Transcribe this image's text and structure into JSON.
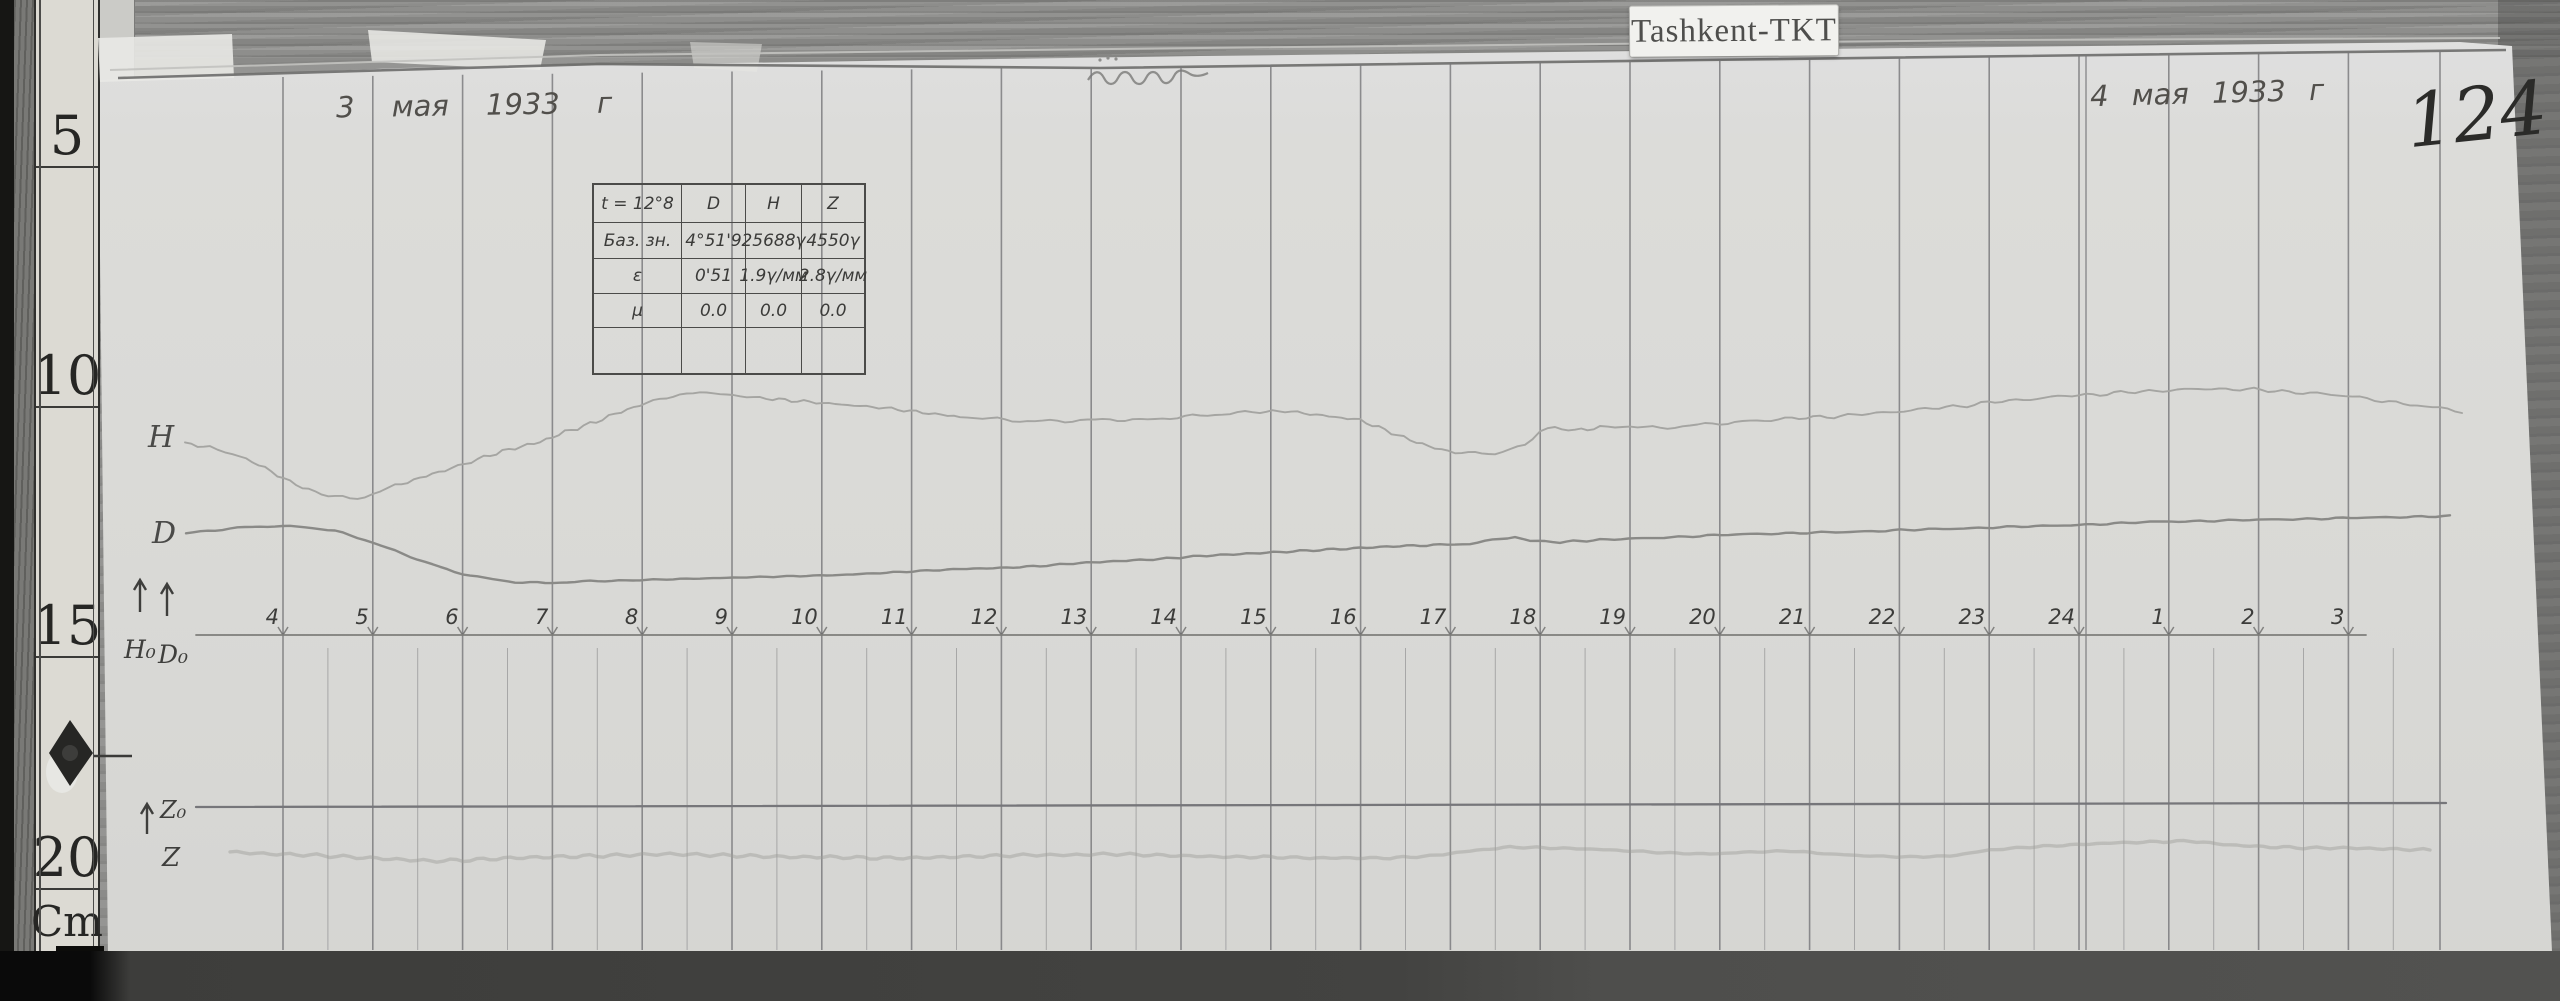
{
  "photo": {
    "station_label": "Tashkent-TKT",
    "page_number": "124",
    "date_left": "3 мая 1933 г",
    "date_right": "4 мая 1933 г",
    "top_center_note": "(illegible pencil scribble)"
  },
  "ruler": {
    "labels": [
      "5",
      "10",
      "15",
      "20",
      "Cm"
    ]
  },
  "trace_labels": {
    "h": "Н",
    "d": "D",
    "h0": "Н₀",
    "d0": "D₀",
    "z0": "Z₀",
    "z": "Z"
  },
  "table": {
    "headers": [
      "t = 12°8",
      "D",
      "H",
      "Z"
    ],
    "rows": [
      [
        "Баз. зн.",
        "4°51'9",
        "25688γ",
        "4550γ"
      ],
      [
        "ε",
        "0'51",
        "1.9γ/мм",
        "2.8γ/мм"
      ],
      [
        "μ",
        "0.0",
        "0.0",
        "0.0"
      ],
      [
        "",
        "",
        "",
        ""
      ]
    ]
  },
  "chart_layout": {
    "first_hour_x": 283,
    "hour_spacing": 89.8,
    "bottom_y": 950,
    "half_line_top": 648,
    "label_y": 624,
    "baseline_y": 635,
    "extra_line_x": 2440,
    "double_line_hour": "24",
    "top_rule": {
      "x1": 118,
      "y1": 79,
      "x2": 2506,
      "y2": 50
    },
    "top_rule_pts": "118,78 600,64 1100,68 1700,60 2506,50",
    "paper_edge_pts": "110,70 600,55 1200,48 2000,40 2500,38",
    "colors": {
      "grid": "#77777a",
      "tick": "#5d5d5b",
      "hour_text": "#3c3c3a"
    }
  },
  "chart_data": {
    "type": "line",
    "title": "Magnetogram photographic record, Tashkent-TKT, 3–4 мая 1933 г",
    "x_hours": [
      "4",
      "5",
      "6",
      "7",
      "8",
      "9",
      "10",
      "11",
      "12",
      "13",
      "14",
      "15",
      "16",
      "17",
      "18",
      "19",
      "20",
      "21",
      "22",
      "23",
      "24",
      "1",
      "2",
      "3"
    ],
    "grid": "hourly vertical lines, half-hour lines in lower (Z) section",
    "legend_position": "handwritten labels in left margin",
    "series": [
      {
        "key": "h0d0-baseline",
        "name": "Н₀D₀ baseline",
        "straight": true,
        "color": "#7e7e7b",
        "width": 1.8,
        "points": [
          [
            196,
            635
          ],
          [
            2366,
            635
          ]
        ]
      },
      {
        "key": "z0-baseline",
        "name": "Z₀ baseline",
        "straight": true,
        "color": "#76767a",
        "width": 2.3,
        "points": [
          [
            196,
            807
          ],
          [
            2446,
            803
          ]
        ]
      },
      {
        "key": "z",
        "name": "Z trace",
        "color": "#9d9d9a",
        "width": 3.4,
        "opacity": 0.45,
        "jitter": 0.8,
        "points": [
          [
            230,
            852
          ],
          [
            270,
            854
          ],
          [
            310,
            855
          ],
          [
            350,
            857
          ],
          [
            390,
            859
          ],
          [
            430,
            861
          ],
          [
            470,
            860
          ],
          [
            510,
            858
          ],
          [
            550,
            857
          ],
          [
            590,
            856
          ],
          [
            630,
            855
          ],
          [
            670,
            854
          ],
          [
            710,
            855
          ],
          [
            750,
            856
          ],
          [
            790,
            857
          ],
          [
            830,
            857
          ],
          [
            870,
            858
          ],
          [
            910,
            858
          ],
          [
            950,
            857
          ],
          [
            990,
            856
          ],
          [
            1030,
            855
          ],
          [
            1070,
            855
          ],
          [
            1110,
            854
          ],
          [
            1150,
            855
          ],
          [
            1190,
            856
          ],
          [
            1230,
            857
          ],
          [
            1270,
            857
          ],
          [
            1310,
            858
          ],
          [
            1350,
            858
          ],
          [
            1390,
            858
          ],
          [
            1430,
            856
          ],
          [
            1470,
            851
          ],
          [
            1510,
            847
          ],
          [
            1550,
            848
          ],
          [
            1590,
            849
          ],
          [
            1630,
            851
          ],
          [
            1670,
            853
          ],
          [
            1710,
            854
          ],
          [
            1750,
            852
          ],
          [
            1790,
            851
          ],
          [
            1830,
            854
          ],
          [
            1870,
            856
          ],
          [
            1910,
            857
          ],
          [
            1950,
            856
          ],
          [
            1990,
            850
          ],
          [
            2030,
            847
          ],
          [
            2070,
            845
          ],
          [
            2110,
            843
          ],
          [
            2150,
            842
          ],
          [
            2190,
            841
          ],
          [
            2230,
            845
          ],
          [
            2270,
            847
          ],
          [
            2310,
            848
          ],
          [
            2350,
            848
          ],
          [
            2390,
            849
          ],
          [
            2430,
            850
          ]
        ]
      },
      {
        "key": "d",
        "name": "D trace",
        "color": "#8a8a87",
        "width": 2.4,
        "jitter": 0.5,
        "points": [
          [
            186,
            533
          ],
          [
            215,
            530
          ],
          [
            245,
            527
          ],
          [
            275,
            526
          ],
          [
            305,
            527
          ],
          [
            335,
            531
          ],
          [
            365,
            540
          ],
          [
            395,
            551
          ],
          [
            425,
            562
          ],
          [
            455,
            572
          ],
          [
            485,
            578
          ],
          [
            515,
            582
          ],
          [
            545,
            583
          ],
          [
            575,
            582
          ],
          [
            605,
            581
          ],
          [
            640,
            580
          ],
          [
            680,
            579
          ],
          [
            720,
            578
          ],
          [
            760,
            577
          ],
          [
            800,
            576
          ],
          [
            840,
            575
          ],
          [
            880,
            573
          ],
          [
            920,
            571
          ],
          [
            960,
            569
          ],
          [
            1000,
            568
          ],
          [
            1040,
            566
          ],
          [
            1080,
            563
          ],
          [
            1120,
            561
          ],
          [
            1160,
            559
          ],
          [
            1200,
            556
          ],
          [
            1240,
            554
          ],
          [
            1280,
            552
          ],
          [
            1320,
            550
          ],
          [
            1360,
            548
          ],
          [
            1400,
            546
          ],
          [
            1440,
            545
          ],
          [
            1470,
            544
          ],
          [
            1500,
            539
          ],
          [
            1515,
            537
          ],
          [
            1530,
            541
          ],
          [
            1560,
            542
          ],
          [
            1600,
            540
          ],
          [
            1650,
            538
          ],
          [
            1700,
            536
          ],
          [
            1750,
            534
          ],
          [
            1800,
            533
          ],
          [
            1850,
            532
          ],
          [
            1900,
            530
          ],
          [
            1950,
            529
          ],
          [
            2000,
            527
          ],
          [
            2050,
            526
          ],
          [
            2100,
            524
          ],
          [
            2150,
            522
          ],
          [
            2200,
            521
          ],
          [
            2250,
            520
          ],
          [
            2300,
            519
          ],
          [
            2350,
            518
          ],
          [
            2400,
            517
          ],
          [
            2450,
            516
          ]
        ]
      },
      {
        "key": "h",
        "name": "H trace",
        "color": "#a5a5a2",
        "width": 1.9,
        "jitter": 1.1,
        "points": [
          [
            185,
            443
          ],
          [
            210,
            448
          ],
          [
            240,
            456
          ],
          [
            265,
            468
          ],
          [
            290,
            482
          ],
          [
            315,
            492
          ],
          [
            335,
            497
          ],
          [
            350,
            499
          ],
          [
            365,
            497
          ],
          [
            380,
            492
          ],
          [
            395,
            486
          ],
          [
            420,
            478
          ],
          [
            445,
            470
          ],
          [
            465,
            464
          ],
          [
            490,
            455
          ],
          [
            515,
            448
          ],
          [
            540,
            442
          ],
          [
            565,
            432
          ],
          [
            590,
            424
          ],
          [
            615,
            414
          ],
          [
            640,
            405
          ],
          [
            660,
            399
          ],
          [
            680,
            395
          ],
          [
            700,
            392
          ],
          [
            720,
            394
          ],
          [
            740,
            396
          ],
          [
            760,
            398
          ],
          [
            785,
            400
          ],
          [
            810,
            402
          ],
          [
            835,
            404
          ],
          [
            860,
            406
          ],
          [
            885,
            408
          ],
          [
            910,
            411
          ],
          [
            935,
            414
          ],
          [
            960,
            417
          ],
          [
            990,
            419
          ],
          [
            1020,
            421
          ],
          [
            1050,
            421
          ],
          [
            1080,
            420
          ],
          [
            1110,
            419
          ],
          [
            1140,
            420
          ],
          [
            1170,
            418
          ],
          [
            1200,
            416
          ],
          [
            1230,
            414
          ],
          [
            1260,
            412
          ],
          [
            1285,
            411
          ],
          [
            1310,
            414
          ],
          [
            1335,
            417
          ],
          [
            1360,
            420
          ],
          [
            1385,
            430
          ],
          [
            1410,
            440
          ],
          [
            1435,
            448
          ],
          [
            1455,
            453
          ],
          [
            1475,
            452
          ],
          [
            1495,
            455
          ],
          [
            1510,
            450
          ],
          [
            1525,
            444
          ],
          [
            1540,
            432
          ],
          [
            1555,
            428
          ],
          [
            1575,
            430
          ],
          [
            1600,
            428
          ],
          [
            1630,
            426
          ],
          [
            1660,
            428
          ],
          [
            1690,
            425
          ],
          [
            1720,
            423
          ],
          [
            1750,
            421
          ],
          [
            1785,
            419
          ],
          [
            1820,
            417
          ],
          [
            1855,
            415
          ],
          [
            1890,
            412
          ],
          [
            1925,
            409
          ],
          [
            1960,
            406
          ],
          [
            1995,
            402
          ],
          [
            2030,
            399
          ],
          [
            2065,
            396
          ],
          [
            2100,
            394
          ],
          [
            2135,
            392
          ],
          [
            2170,
            390
          ],
          [
            2205,
            389
          ],
          [
            2240,
            389
          ],
          [
            2275,
            391
          ],
          [
            2310,
            393
          ],
          [
            2345,
            396
          ],
          [
            2375,
            400
          ],
          [
            2410,
            404
          ],
          [
            2440,
            408
          ],
          [
            2462,
            411
          ]
        ]
      }
    ]
  }
}
